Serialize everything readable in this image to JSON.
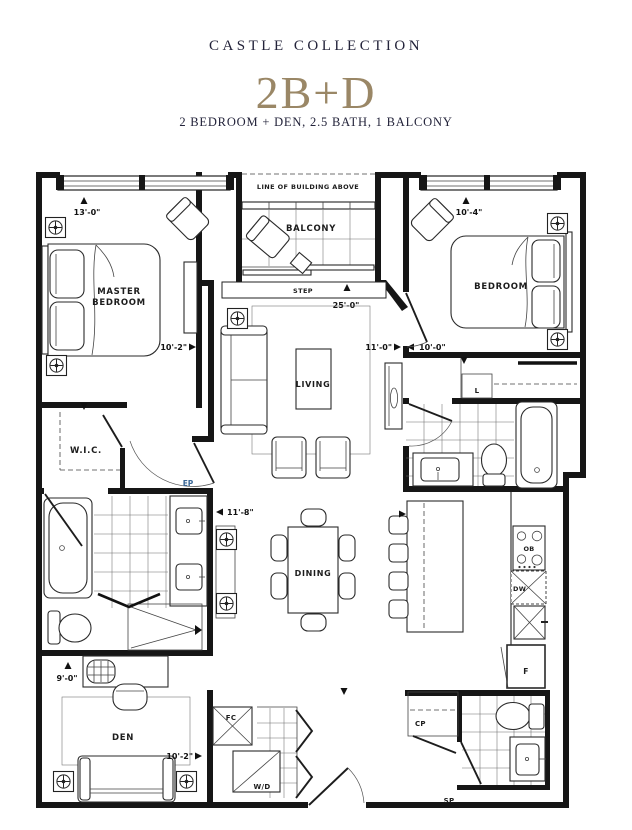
{
  "header": {
    "collection": "CASTLE COLLECTION",
    "plan": "2B+D",
    "subtitle": "2 BEDROOM + DEN, 2.5 BATH, 1 BALCONY",
    "accent_color": "#9a8766",
    "text_color": "#23233a"
  },
  "labels": {
    "line_of_building": "LINE OF BUILDING ABOVE",
    "balcony": "BALCONY",
    "step": "STEP",
    "master1": "MASTER",
    "master2": "BEDROOM",
    "bedroom": "BEDROOM",
    "living": "LIVING",
    "wic": "W.I.C.",
    "dining": "DINING",
    "den": "DEN",
    "ep": "EP",
    "linen": "L",
    "ob": "OB",
    "dw": "DW",
    "fridge": "F",
    "fc": "FC",
    "wd": "W/D",
    "cp": "CP",
    "sp": "SP"
  },
  "dimensions": {
    "master_w": "13'-0\"",
    "master_d": "10'-2\"",
    "overall": "25'-0\"",
    "bedroom_w": "10'-4\"",
    "bedroom_d": "10'-0\"",
    "living_w": "11'-0\"",
    "ensuite_w": "11'-8\"",
    "den_w": "9'-0\"",
    "den_d": "10'-2\""
  }
}
